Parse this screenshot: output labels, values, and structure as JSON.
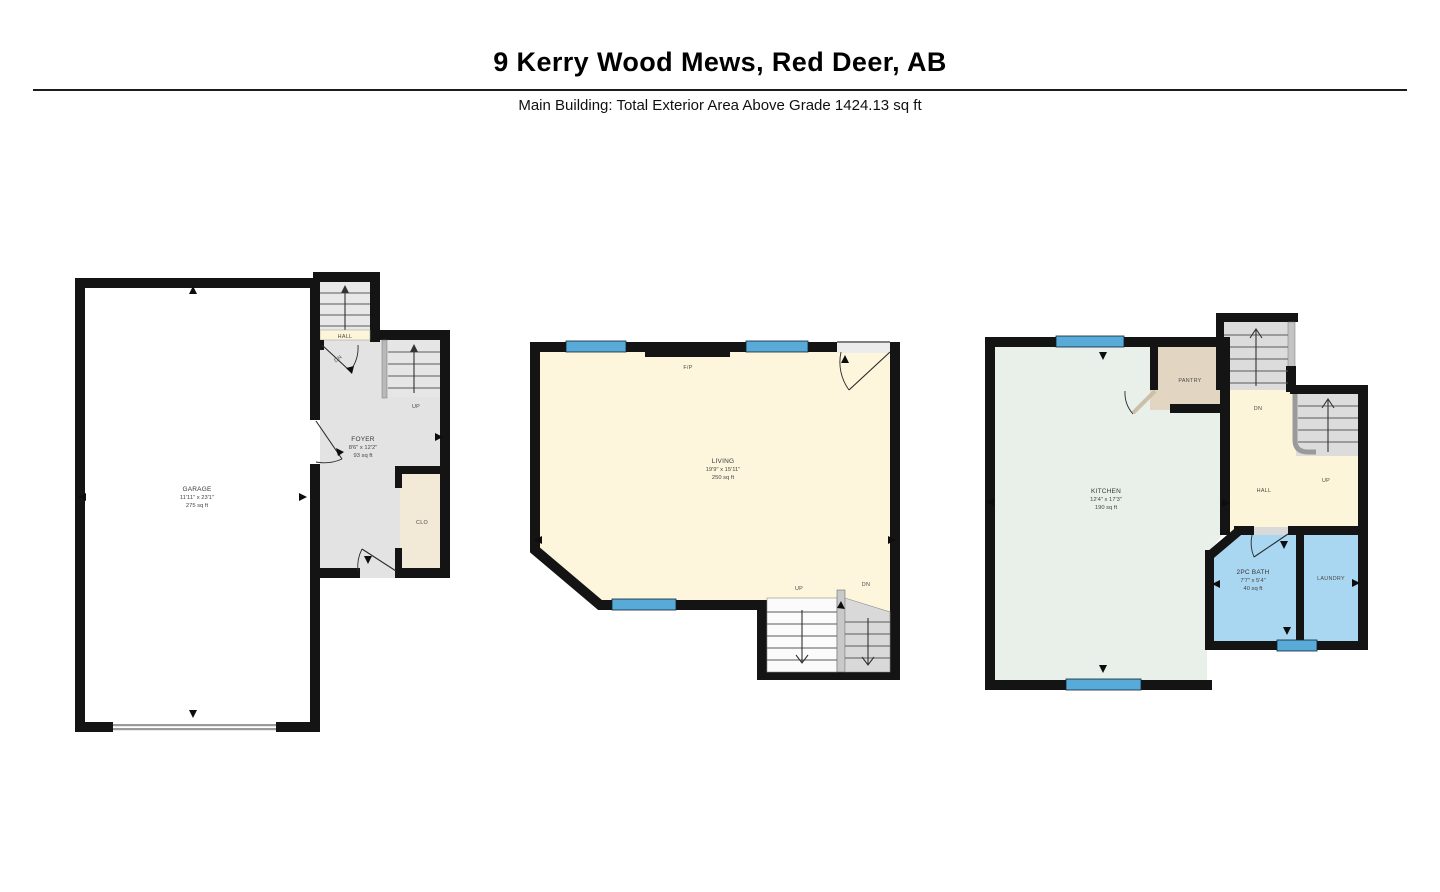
{
  "header": {
    "title": "9 Kerry Wood Mews, Red Deer, AB",
    "subtitle": "Main Building: Total Exterior Area Above Grade 1424.13 sq ft"
  },
  "colors": {
    "wall": "#141414",
    "window_blue": "#58aad9",
    "living_cream": "#fdf6dd",
    "kitchen_mint": "#e9f0e9",
    "foyer_gray": "#e3e3e3",
    "bath_blue": "#a9d6f1",
    "pantry_tan": "#e2d5c2",
    "closet_tan": "#f2ead7",
    "hall_cream": "#fcf5da",
    "stair_gray": "#dcdcdc"
  },
  "floorplans": {
    "left": {
      "garage": {
        "name": "GARAGE",
        "dims": "11'11\" x 23'1\"",
        "area": "275 sq ft"
      },
      "foyer": {
        "name": "FOYER",
        "dims": "8'6\" x 12'2\"",
        "area": "93 sq ft"
      },
      "hall": "HALL",
      "closet": "CLO",
      "up": "UP",
      "dn": "DN"
    },
    "middle": {
      "living": {
        "name": "LIVING",
        "dims": "19'9\" x 15'11\"",
        "area": "250 sq ft"
      },
      "fireplace": "F/P",
      "up": "UP",
      "dn": "DN"
    },
    "right": {
      "kitchen": {
        "name": "KITCHEN",
        "dims": "12'4\" x 17'3\"",
        "area": "190 sq ft"
      },
      "pantry": "PANTRY",
      "hall": "HALL",
      "bath": {
        "name": "2PC BATH",
        "dims": "7'7\" x 5'4\"",
        "area": "40 sq ft"
      },
      "laundry": "LAUNDRY",
      "up": "UP",
      "dn": "DN"
    }
  }
}
